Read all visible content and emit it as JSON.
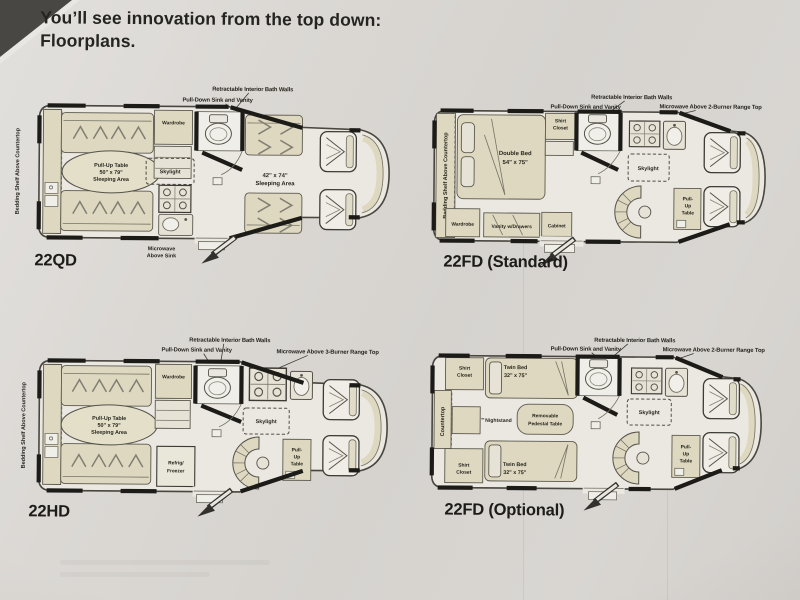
{
  "page": {
    "title_line1": "You’ll see innovation from the top down:",
    "title_line2": "Floorplans."
  },
  "colors": {
    "paper": "#d8d5d1",
    "ink": "#23221c",
    "furniture_beige": "#ddd8bf",
    "photo_corner": "#494743"
  },
  "plans": {
    "p1": {
      "name": "22QD",
      "side": "Bedding Shelf Above Countertop",
      "c_bath": "Retractable Interior Bath Walls",
      "c_sink": "Pull-Down Sink and Vanity",
      "micro1": "Microwave",
      "micro2": "Above Sink",
      "wardrobe": "Wardrobe",
      "t1": "Pull-Up Table",
      "t2": "50\" x 79\"",
      "t3": "Sleeping Area",
      "skylight": "Skylight",
      "s1": "42\" x 74\"",
      "s2": "Sleeping Area"
    },
    "p2": {
      "name": "22FD (Standard)",
      "side": "Bedding Shelf Above Countertop",
      "c_bath": "Retractable Interior Bath Walls",
      "c_sink": "Pull-Down Sink and Vanity",
      "c_micro": "Microwave Above 2-Burner Range Top",
      "shirt1": "Shirt",
      "shirt2": "Closet",
      "bed1": "Double Bed",
      "bed2": "54\" x 75\"",
      "skylight": "Skylight",
      "pu1": "Pull-",
      "pu2": "Up",
      "pu3": "Table",
      "wardrobe": "Wardrobe",
      "vanity": "Vanity w/Drawers",
      "cabinet": "Cabinet"
    },
    "p3": {
      "name": "22HD",
      "side": "Bedding Shelf Above Countertop",
      "c_bath": "Retractable Interior Bath Walls",
      "c_sink": "Pull-Down Sink and Vanity",
      "c_micro": "Microwave Above 3-Burner Range Top",
      "wardrobe": "Wardrobe",
      "t1": "Pull-Up Table",
      "t2": "50\" x 79\"",
      "t3": "Sleeping Area",
      "skylight": "Skylight",
      "fr1": "Refrig/",
      "fr2": "Freezer",
      "pu1": "Pull-",
      "pu2": "Up",
      "pu3": "Table"
    },
    "p4": {
      "name": "22FD (Optional)",
      "side": "Countertop",
      "c_bath": "Retractable Interior Bath Walls",
      "c_sink": "Pull-Down Sink and Vanity",
      "c_micro": "Microwave Above 2-Burner Range Top",
      "shirt1": "Shirt",
      "shirt2": "Closet",
      "bed1": "Twin Bed",
      "bed2": "32\" x 75\"",
      "nightstand": "Nightstand",
      "ped1": "Removable",
      "ped2": "Pedestal Table",
      "skylight": "Skylight",
      "pu1": "Pull-",
      "pu2": "Up",
      "pu3": "Table"
    }
  }
}
